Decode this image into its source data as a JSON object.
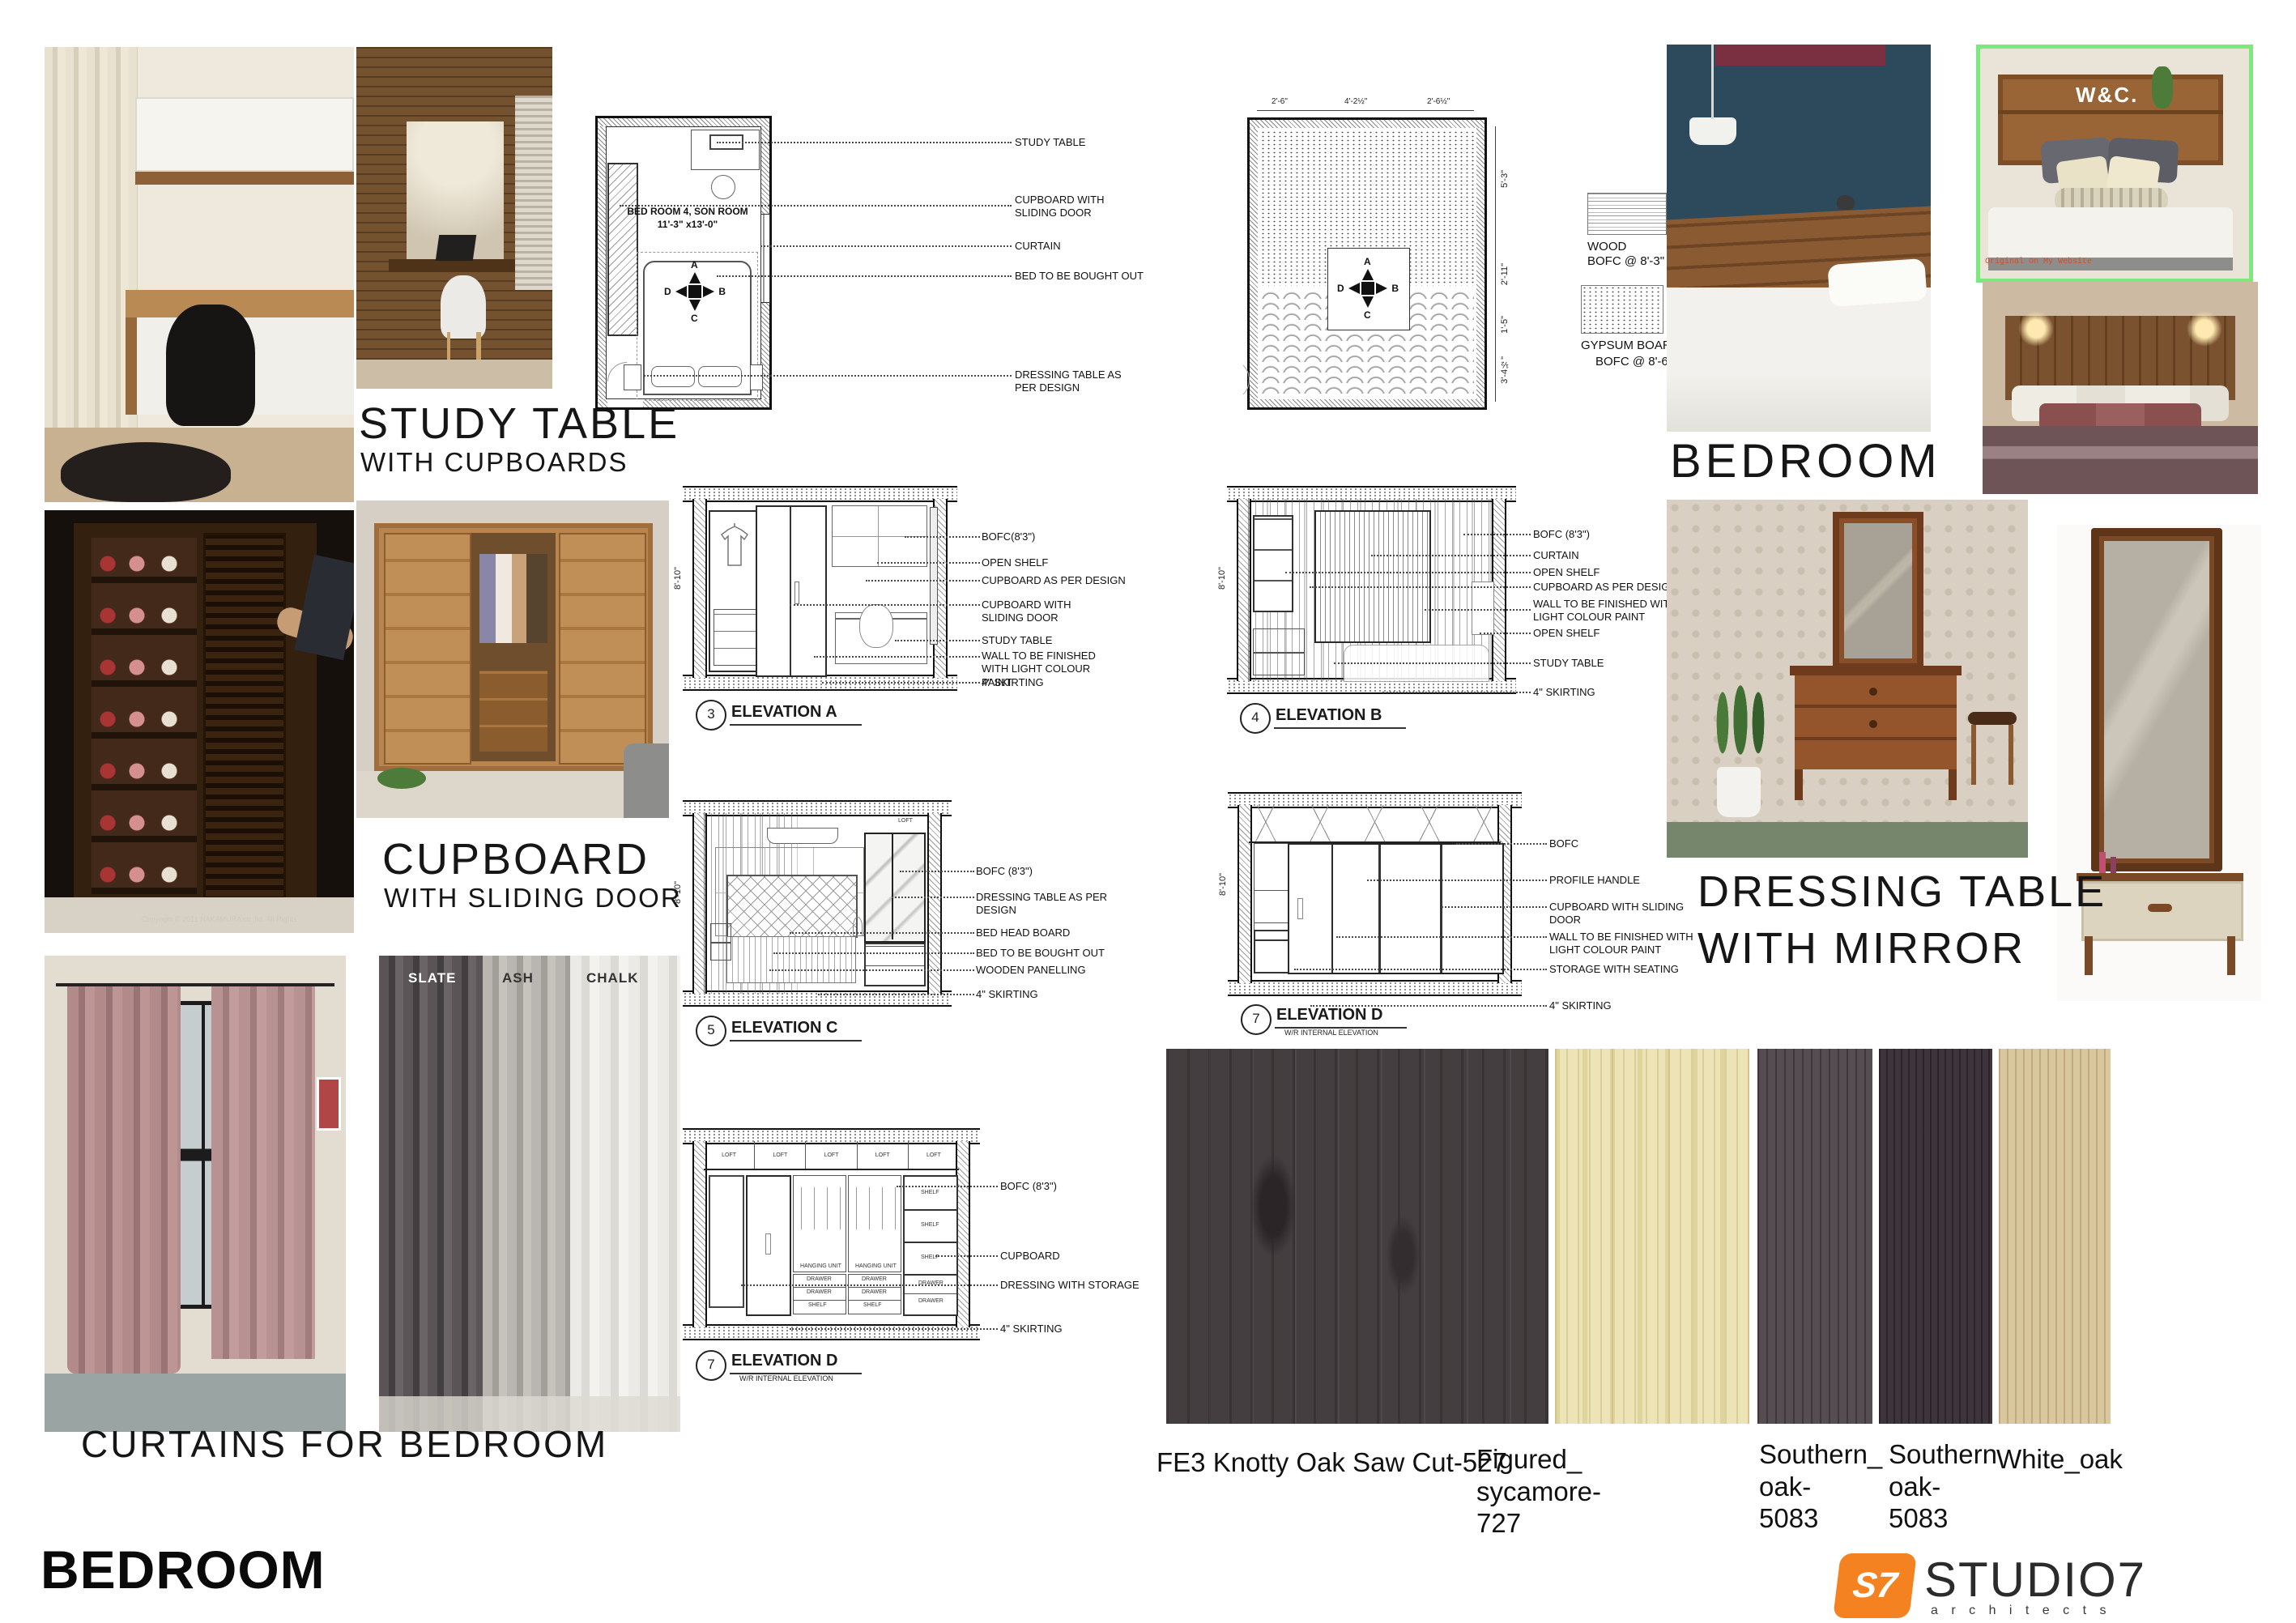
{
  "titles": {
    "study": "STUDY TABLE",
    "study_sub": "WITH CUPBOARDS",
    "cupboard": "CUPBOARD",
    "cupboard_sub": "WITH SLIDING DOOR",
    "curtains": "CURTAINS FOR BEDROOM",
    "bedroom_left": "BEDROOM",
    "bedroom_right": "BEDROOM",
    "dressing1": "DRESSING TABLE",
    "dressing2": "WITH MIRROR"
  },
  "photos": {
    "curtain_shades": [
      "SLATE",
      "ASH",
      "CHALK"
    ],
    "cupboard_watermark": "Copyright © 2011 NAKAMURA co.,ltd. All Rights",
    "headboard_letters": "W&C.",
    "wc_caption": "Original On My Website"
  },
  "floor_plan": {
    "room_name": "BED ROOM 4, SON ROOM",
    "room_size": "11'-3\" x13'-0\"",
    "compass": {
      "top": "A",
      "right": "B",
      "bottom": "C",
      "left": "D"
    },
    "callouts": [
      "STUDY TABLE",
      "CUPBOARD WITH SLIDING DOOR",
      "CURTAIN",
      "BED TO BE BOUGHT OUT",
      "DRESSING TABLE AS PER DESIGN"
    ]
  },
  "ceiling_plan": {
    "dims_top": [
      "2'-6\"",
      "4'-2½\"",
      "2'-6½\""
    ],
    "dims_right": [
      "5'-3\"",
      "2'-11\"",
      "1'-5\"",
      "3'-4½\""
    ],
    "compass": {
      "top": "A",
      "right": "B",
      "bottom": "C",
      "left": "D"
    },
    "legend": [
      {
        "name": "WOOD",
        "bofc": "BOFC @ 8'-3\""
      },
      {
        "name": "GYPSUM BOARD",
        "bofc": "BOFC @ 8'-6\""
      }
    ]
  },
  "elevations": {
    "a": {
      "num": "3",
      "title": "ELEVATION A",
      "dim": "8'-10\"",
      "callouts": [
        "BOFC(8'3\")",
        "OPEN SHELF",
        "CUPBOARD AS PER DESIGN",
        "CUPBOARD WITH SLIDING DOOR",
        "STUDY TABLE",
        "WALL TO BE FINISHED WITH LIGHT COLOUR PAINT",
        "4\" SKIRTING"
      ]
    },
    "b": {
      "num": "4",
      "title": "ELEVATION B",
      "dim": "8'-10\"",
      "callouts": [
        "BOFC (8'3\")",
        "CURTAIN",
        "OPEN SHELF",
        "CUPBOARD AS PER DESIGN",
        "WALL TO BE FINISHED WITH LIGHT COLOUR PAINT",
        "OPEN SHELF",
        "STUDY TABLE",
        "4\" SKIRTING"
      ]
    },
    "c": {
      "num": "5",
      "title": "ELEVATION C",
      "dim": "8'-10\"",
      "callouts": [
        "BOFC (8'3\")",
        "DRESSING TABLE AS PER DESIGN",
        "BED HEAD BOARD",
        "BED TO BE BOUGHT OUT",
        "WOODEN PANELLING",
        "4\" SKIRTING"
      ]
    },
    "d1": {
      "num": "7",
      "title": "ELEVATION D",
      "sub": "W/R INTERNAL ELEVATION",
      "dim": "8'-10\"",
      "callouts": [
        "BOFC",
        "PROFILE HANDLE",
        "CUPBOARD WITH SLIDING DOOR",
        "WALL TO BE FINISHED WITH LIGHT COLOUR PAINT",
        "STORAGE WITH SEATING",
        "4\" SKIRTING"
      ]
    },
    "d2": {
      "num": "7",
      "title": "ELEVATION D",
      "sub": "W/R INTERNAL ELEVATION",
      "callouts": [
        "BOFC (8'3\")",
        "CUPBOARD",
        "DRESSING WITH STORAGE",
        "4\" SKIRTING"
      ],
      "inner_labels": {
        "loft": "LOFT",
        "shelf": "SHELF",
        "drawer": "DRAWER",
        "hanging": "HANGING UNIT"
      }
    }
  },
  "materials": [
    {
      "label": "FE3 Knotty Oak Saw Cut-527",
      "hex": "#453e40"
    },
    {
      "label": "Figured_\nsycamore-\n727",
      "hex": "#ece4b6"
    },
    {
      "label": "Southern_\noak-\n5083",
      "hex": "#554d51"
    },
    {
      "label": "Southern\noak-\n5083",
      "hex": "#3e353c"
    },
    {
      "label": "White_oak",
      "hex": "#d9c79e"
    }
  ],
  "logo": {
    "mark": "S7",
    "name": "STUDIO7",
    "sub": "a r c h i t e c t s",
    "accent": "#f58220"
  }
}
